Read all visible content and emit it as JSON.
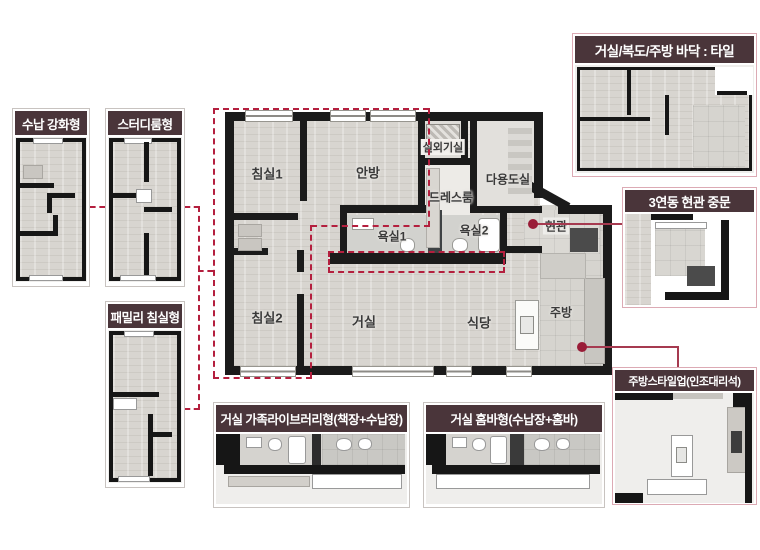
{
  "palette": {
    "header_bg": "#4a353a",
    "dashed_line": "#b41f3e",
    "solid_line": "#a63a50",
    "dot": "#991c37",
    "wall": "#1b1b1b",
    "floor": "#d8d5d0"
  },
  "main_plan": {
    "rooms": {
      "bedroom1": "침실1",
      "master": "안방",
      "ac_unit": "실외기실",
      "dress": "드레스룸",
      "utility": "다용도실",
      "bath1": "욕실1",
      "bath2": "욕실2",
      "entrance": "현관",
      "bedroom2": "침실2",
      "living": "거실",
      "dining": "식당",
      "kitchen": "주방"
    }
  },
  "callouts": {
    "storage": "수납 강화형",
    "study": "스터디룸형",
    "family": "패밀리 침실형",
    "tile": "거실/복도/주방 바닥 : 타일",
    "door": "3연동 현관 중문",
    "styleup": "주방스타일업(인조대리석)",
    "library": "거실 가족라이브러리형(책장+수납장)",
    "homebar": "거실 홈바형(수납장+홈바)"
  }
}
